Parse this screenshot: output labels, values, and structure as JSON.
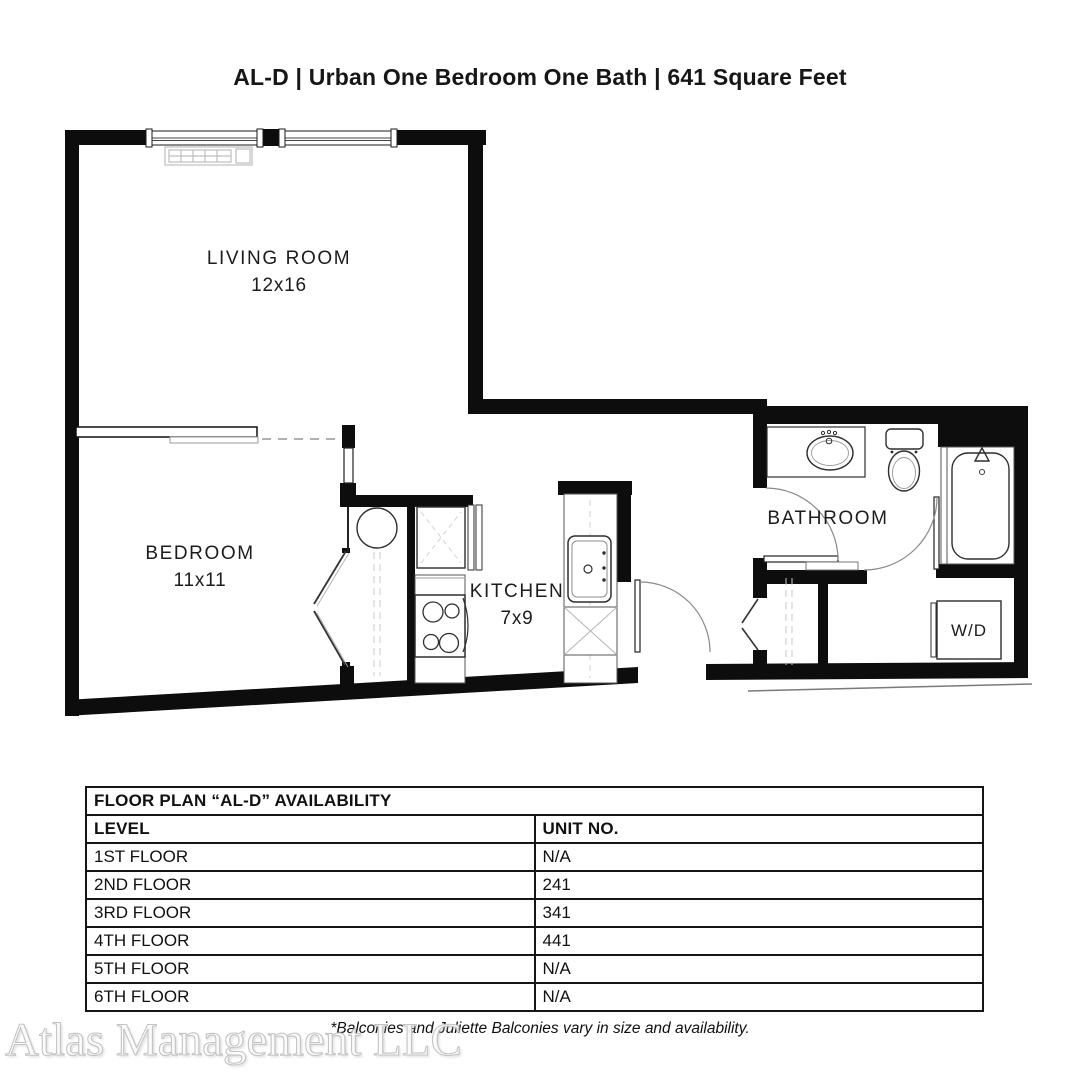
{
  "page": {
    "title": "AL-D | Urban One Bedroom One Bath | 641 Square Feet"
  },
  "floor_plan": {
    "living_room": {
      "label": "LIVING ROOM",
      "dims": "12x16"
    },
    "bedroom": {
      "label": "BEDROOM",
      "dims": "11x11"
    },
    "kitchen": {
      "label": "KITCHEN",
      "dims": "7x9"
    },
    "bathroom": {
      "label": "BATHROOM"
    },
    "washer_dryer": {
      "label": "W/D"
    }
  },
  "availability_table": {
    "title": "FLOOR PLAN “AL-D” AVAILABILITY",
    "columns": {
      "level": "LEVEL",
      "unit": "UNIT NO."
    },
    "rows": [
      {
        "level": "1ST FLOOR",
        "unit": "N/A"
      },
      {
        "level": "2ND FLOOR",
        "unit": "241"
      },
      {
        "level": "3RD FLOOR",
        "unit": "341"
      },
      {
        "level": "4TH FLOOR",
        "unit": "441"
      },
      {
        "level": "5TH FLOOR",
        "unit": "N/A"
      },
      {
        "level": "6TH FLOOR",
        "unit": "N/A"
      }
    ]
  },
  "footnote": "*Balconies and Juliette Balconies vary in size and availability.",
  "watermark": "Atlas Management LLC",
  "colors": {
    "wall": "#0d0d0d",
    "line": "#2e2e2e",
    "light_line": "#b5b5b5"
  }
}
